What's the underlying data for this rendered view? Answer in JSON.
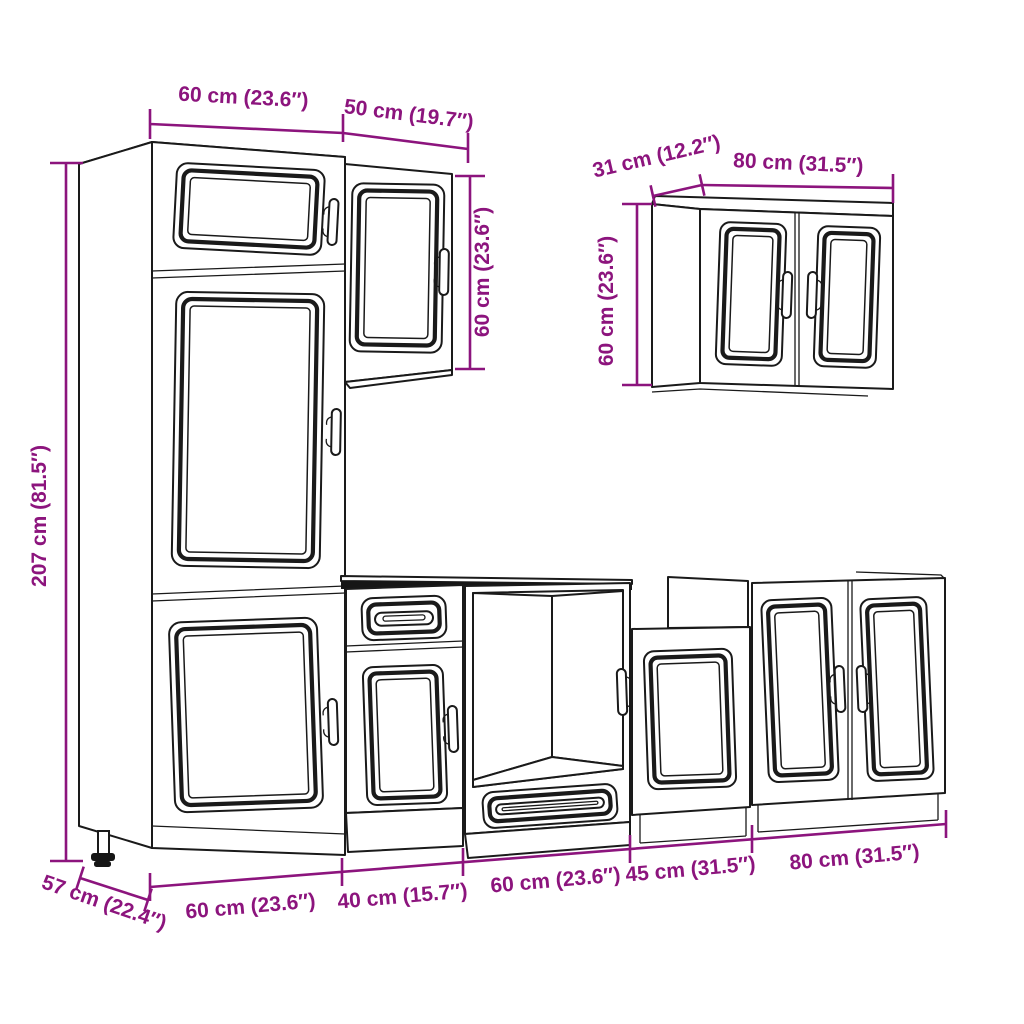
{
  "colors": {
    "dimension_accent": "#8c147d",
    "line": "#1a1a1a",
    "background": "#ffffff",
    "countertop_band": "#161616"
  },
  "dimensions": {
    "tall_cabinet_width": "60 cm (23.6″)",
    "wall_cabinet_50_width": "50 cm (19.7″)",
    "wall_cabinet_50_height": "60 cm (23.6″)",
    "wall_cabinet_80_depth": "31 cm (12.2″)",
    "wall_cabinet_80_width": "80 cm (31.5″)",
    "wall_cabinet_80_height": "60 cm (23.6″)",
    "tall_cabinet_height": "207 cm (81.5″)",
    "tall_cabinet_depth": "57 cm (22.4″)",
    "base_run_1_width": "60 cm (23.6″)",
    "base_run_2_width": "40 cm (15.7″)",
    "base_run_3_width": "60 cm (23.6″)",
    "base_run_4_width": "45 cm (31.5″)",
    "base_run_5_width": "80 cm (31.5″)"
  }
}
